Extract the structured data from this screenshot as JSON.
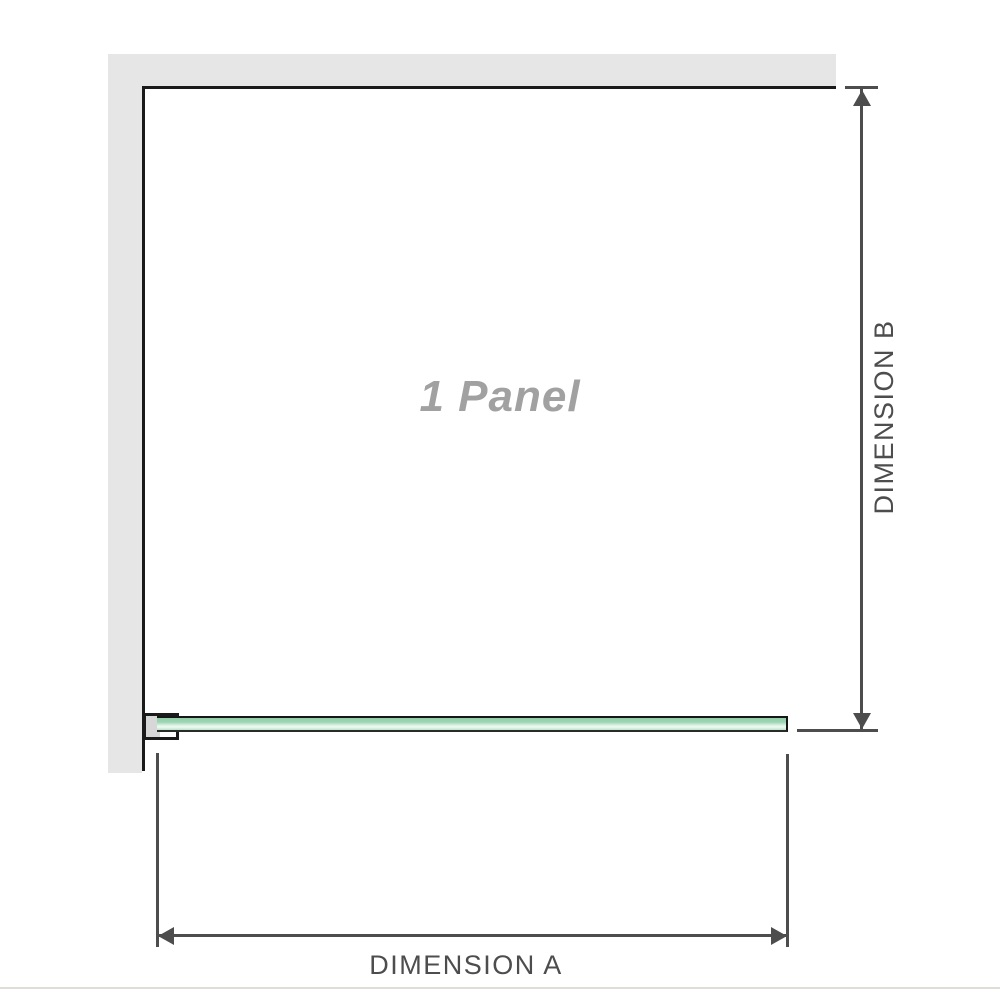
{
  "diagram": {
    "panel_label": "1 Panel",
    "dimensions": {
      "horizontal": "DIMENSION A",
      "vertical": "DIMENSION B"
    }
  },
  "colors": {
    "background": "#ffffff",
    "wall_fill": "#e6e6e6",
    "wall_edge": "#1a1a1a",
    "dimension_lines_and_text": "#4d4d4d",
    "glass_border": "#161616",
    "glass_green_dark": "#8fcea9",
    "glass_green_light": "#f0faf4",
    "bracket_pad_fill": "#d7d7d7",
    "panel_label_text": "#a1a1a1",
    "bottom_rule": "#deddd6"
  }
}
